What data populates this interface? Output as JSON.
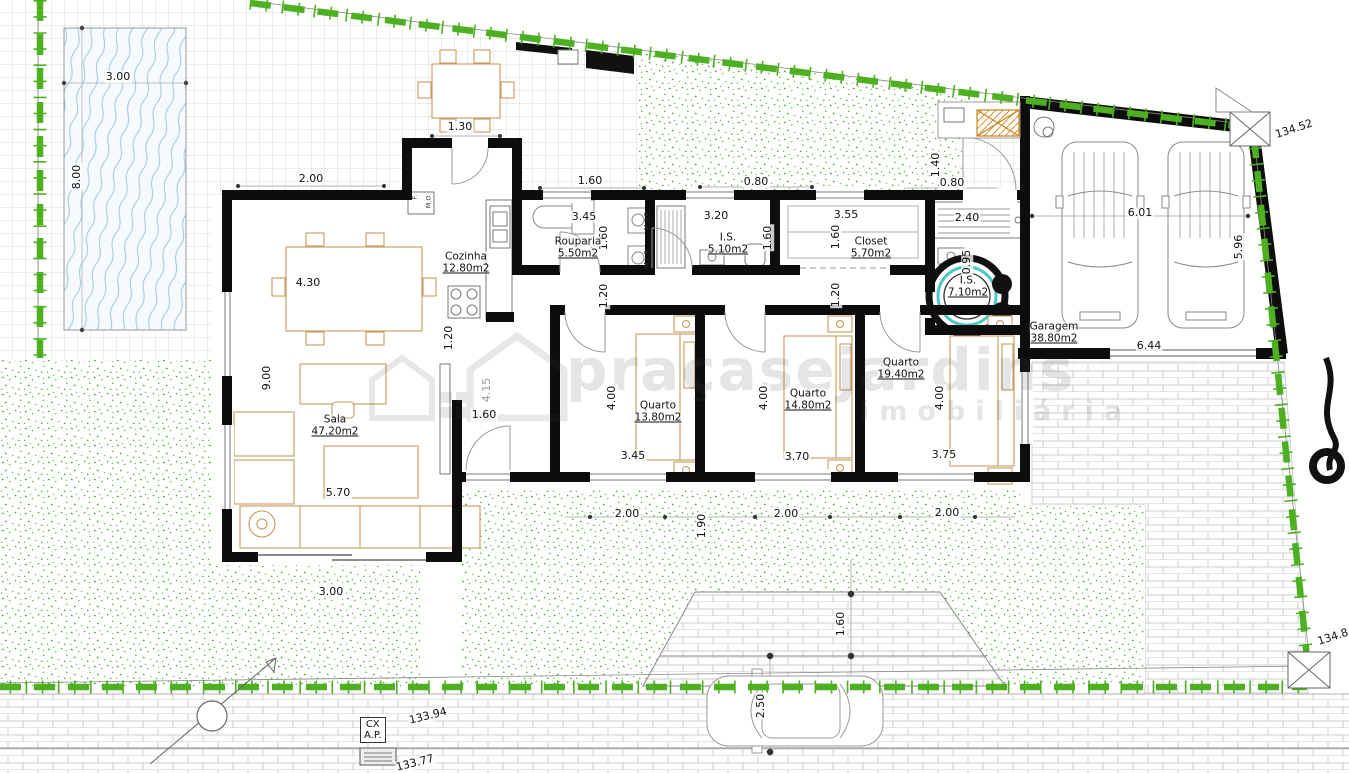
{
  "watermark": {
    "brand": "praçasejardins",
    "tagline": "imobiliária"
  },
  "utility_box": {
    "line1": "CX",
    "line2": "A.P."
  },
  "rooms": [
    {
      "name": "Cozinha",
      "area": "12.80m2",
      "x": 466,
      "y": 257
    },
    {
      "name": "Rouparia",
      "area": "5.50m2",
      "x": 578,
      "y": 242
    },
    {
      "name": "I.S.",
      "area": "5.10m2",
      "x": 728,
      "y": 238
    },
    {
      "name": "Closet",
      "area": "5.70m2",
      "x": 871,
      "y": 242
    },
    {
      "name": "I.S.",
      "area": "7.10m2",
      "x": 968,
      "y": 281
    },
    {
      "name": "Quarto",
      "area": "13.80m2",
      "x": 658,
      "y": 406
    },
    {
      "name": "Quarto",
      "area": "14.80m2",
      "x": 808,
      "y": 394
    },
    {
      "name": "Quarto",
      "area": "19.40m2",
      "x": 901,
      "y": 363
    },
    {
      "name": "Sala",
      "area": "47.20m2",
      "x": 335,
      "y": 420
    },
    {
      "name": "Garagem",
      "area": "38.80m2",
      "x": 1054,
      "y": 327
    }
  ],
  "dimensions": [
    {
      "t": "3.00",
      "x": 118,
      "y": 77,
      "r": 0
    },
    {
      "t": "8.00",
      "x": 77,
      "y": 177,
      "r": -90
    },
    {
      "t": "1.30",
      "x": 460,
      "y": 127,
      "r": 0
    },
    {
      "t": "2.00",
      "x": 311,
      "y": 179,
      "r": 0
    },
    {
      "t": "1.60",
      "x": 590,
      "y": 181,
      "r": 0
    },
    {
      "t": "0.80",
      "x": 756,
      "y": 182,
      "r": 0
    },
    {
      "t": "1.40",
      "x": 936,
      "y": 165,
      "r": -90
    },
    {
      "t": "0.80",
      "x": 952,
      "y": 183,
      "r": 0
    },
    {
      "t": "3.45",
      "x": 584,
      "y": 217,
      "r": 0
    },
    {
      "t": "3.20",
      "x": 716,
      "y": 216,
      "r": 0
    },
    {
      "t": "3.55",
      "x": 846,
      "y": 215,
      "r": 0
    },
    {
      "t": "2.40",
      "x": 967,
      "y": 218,
      "r": 0
    },
    {
      "t": "1.60",
      "x": 604,
      "y": 238,
      "r": -90
    },
    {
      "t": "1.60",
      "x": 768,
      "y": 238,
      "r": -90
    },
    {
      "t": "1.60",
      "x": 836,
      "y": 237,
      "r": -90
    },
    {
      "t": "0.95",
      "x": 967,
      "y": 262,
      "r": -90
    },
    {
      "t": "1.20",
      "x": 604,
      "y": 296,
      "r": -90
    },
    {
      "t": "1.20",
      "x": 836,
      "y": 295,
      "r": -90
    },
    {
      "t": "4.30",
      "x": 308,
      "y": 283,
      "r": 0
    },
    {
      "t": "1.20",
      "x": 449,
      "y": 338,
      "r": -90
    },
    {
      "t": "9.00",
      "x": 267,
      "y": 378,
      "r": -90
    },
    {
      "t": "4.15",
      "x": 487,
      "y": 390,
      "r": -90,
      "c": "gray"
    },
    {
      "t": "1.60",
      "x": 484,
      "y": 415,
      "r": 0
    },
    {
      "t": "4.00",
      "x": 612,
      "y": 398,
      "r": -90
    },
    {
      "t": "4.00",
      "x": 764,
      "y": 398,
      "r": -90
    },
    {
      "t": "4.00",
      "x": 940,
      "y": 398,
      "r": -90
    },
    {
      "t": "3.45",
      "x": 633,
      "y": 456,
      "r": 0
    },
    {
      "t": "3.70",
      "x": 797,
      "y": 457,
      "r": 0
    },
    {
      "t": "3.75",
      "x": 944,
      "y": 455,
      "r": 0
    },
    {
      "t": "5.70",
      "x": 338,
      "y": 493,
      "r": 0
    },
    {
      "t": "2.00",
      "x": 627,
      "y": 514,
      "r": 0
    },
    {
      "t": "2.00",
      "x": 786,
      "y": 514,
      "r": 0
    },
    {
      "t": "2.00",
      "x": 947,
      "y": 513,
      "r": 0
    },
    {
      "t": "1.90",
      "x": 702,
      "y": 526,
      "r": -90
    },
    {
      "t": "3.00",
      "x": 331,
      "y": 592,
      "r": 0
    },
    {
      "t": "1.60",
      "x": 841,
      "y": 624,
      "r": -90
    },
    {
      "t": "2.50",
      "x": 761,
      "y": 706,
      "r": -90
    },
    {
      "t": "6.01",
      "x": 1140,
      "y": 213,
      "r": 0
    },
    {
      "t": "5.96",
      "x": 1239,
      "y": 247,
      "r": -90
    },
    {
      "t": "6.44",
      "x": 1149,
      "y": 346,
      "r": 0
    },
    {
      "t": "134.52",
      "x": 1294,
      "y": 129,
      "r": -18
    },
    {
      "t": "134.8",
      "x": 1333,
      "y": 637,
      "r": -18
    },
    {
      "t": "133.94",
      "x": 428,
      "y": 716,
      "r": -14
    },
    {
      "t": "133.77",
      "x": 415,
      "y": 763,
      "r": -14
    },
    {
      "t": "M.S.R.",
      "x": 647,
      "y": 220,
      "r": -90,
      "c": "tiny"
    },
    {
      "t": "M.L.R.",
      "x": 647,
      "y": 258,
      "r": -90,
      "c": "tiny"
    },
    {
      "t": "F.",
      "x": 415,
      "y": 197,
      "r": -90,
      "c": "tiny"
    },
    {
      "t": "M.O.",
      "x": 429,
      "y": 201,
      "r": -90,
      "c": "tiny"
    }
  ],
  "colors": {
    "boundary_green": "#4cb021",
    "garden_green": "#3fa42e",
    "furniture_tan": "#c79a5e",
    "water_blue": "#9ec7e0",
    "shower_teal": "#4cc7c3",
    "wall_black": "#0d0d0d"
  }
}
